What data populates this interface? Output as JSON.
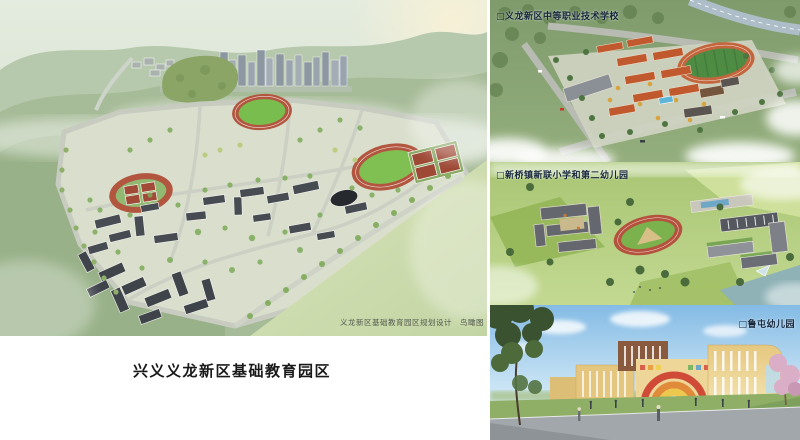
{
  "page_title": "兴义义龙新区基础教育园区",
  "masterplan": {
    "attribution": "义龙新区基础教育园区规划设计　鸟瞰图"
  },
  "right_panels": [
    {
      "id": "vocational-school",
      "label": "□义龙新区中等职业技术学校"
    },
    {
      "id": "primary-school-and-kindergarten",
      "label": "□新桥镇新联小学和第二幼儿园"
    },
    {
      "id": "lutun-kindergarten",
      "label": "□鲁屯幼儿园"
    }
  ],
  "colors": {
    "background": "#ffffff",
    "track_red": "#b25640",
    "sports_field_green": "#7abd4f",
    "vocational_building_orange": "#c05a2e",
    "kindergarten_wall_yellow": "#e6c87f",
    "sky_blue": "#84bbe5",
    "mountain_mist_green": "#a6bb97",
    "label_text": "#16263c",
    "caption_text": "#191919"
  }
}
